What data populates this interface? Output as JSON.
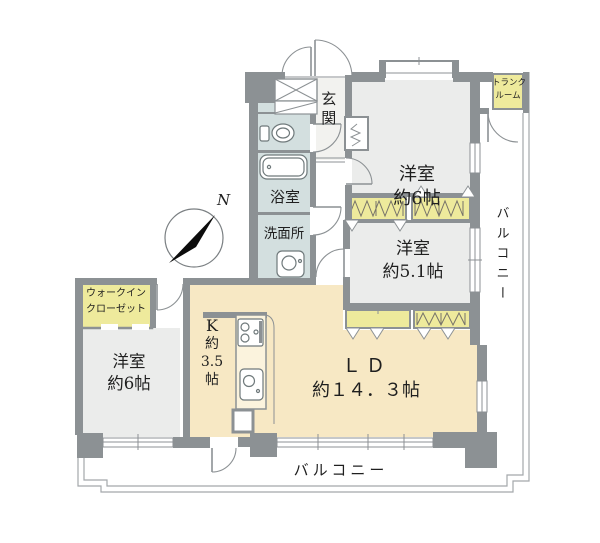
{
  "compass": {
    "label": "N"
  },
  "rooms": {
    "entrance": {
      "label": "玄関"
    },
    "bedroom_top": {
      "name": "洋室",
      "size": "約6帖"
    },
    "trunk_room": {
      "line1": "トランク",
      "line2": "ルーム"
    },
    "balcony_right": {
      "label": "バルコニー"
    },
    "bedroom_mid": {
      "name": "洋室",
      "size": "約5.1帖"
    },
    "bathroom": {
      "label": "浴室"
    },
    "washroom": {
      "label": "洗面所"
    },
    "walk_in_closet": {
      "line1": "ウォークイン",
      "line2": "クローゼット"
    },
    "bedroom_left": {
      "name": "洋室",
      "size": "約6帖"
    },
    "kitchen": {
      "line1": "K",
      "line2": "約",
      "line3": "3.5",
      "line4": "帖"
    },
    "living_dining": {
      "name": "ＬＤ",
      "size": "約１４．３帖"
    },
    "balcony_bottom": {
      "label": "バルコニー"
    }
  },
  "colors": {
    "wall": "#8c9194",
    "room_floor": "#ebeceb",
    "water_area": "#d3dfdf",
    "living_area": "#f7e8c4",
    "closet_yellow": "#eeea9c",
    "entrance_floor": "#f2f2ef",
    "counter": "#fbf3dd",
    "outline": "#a3a8ab",
    "text": "#1f1f1f"
  }
}
